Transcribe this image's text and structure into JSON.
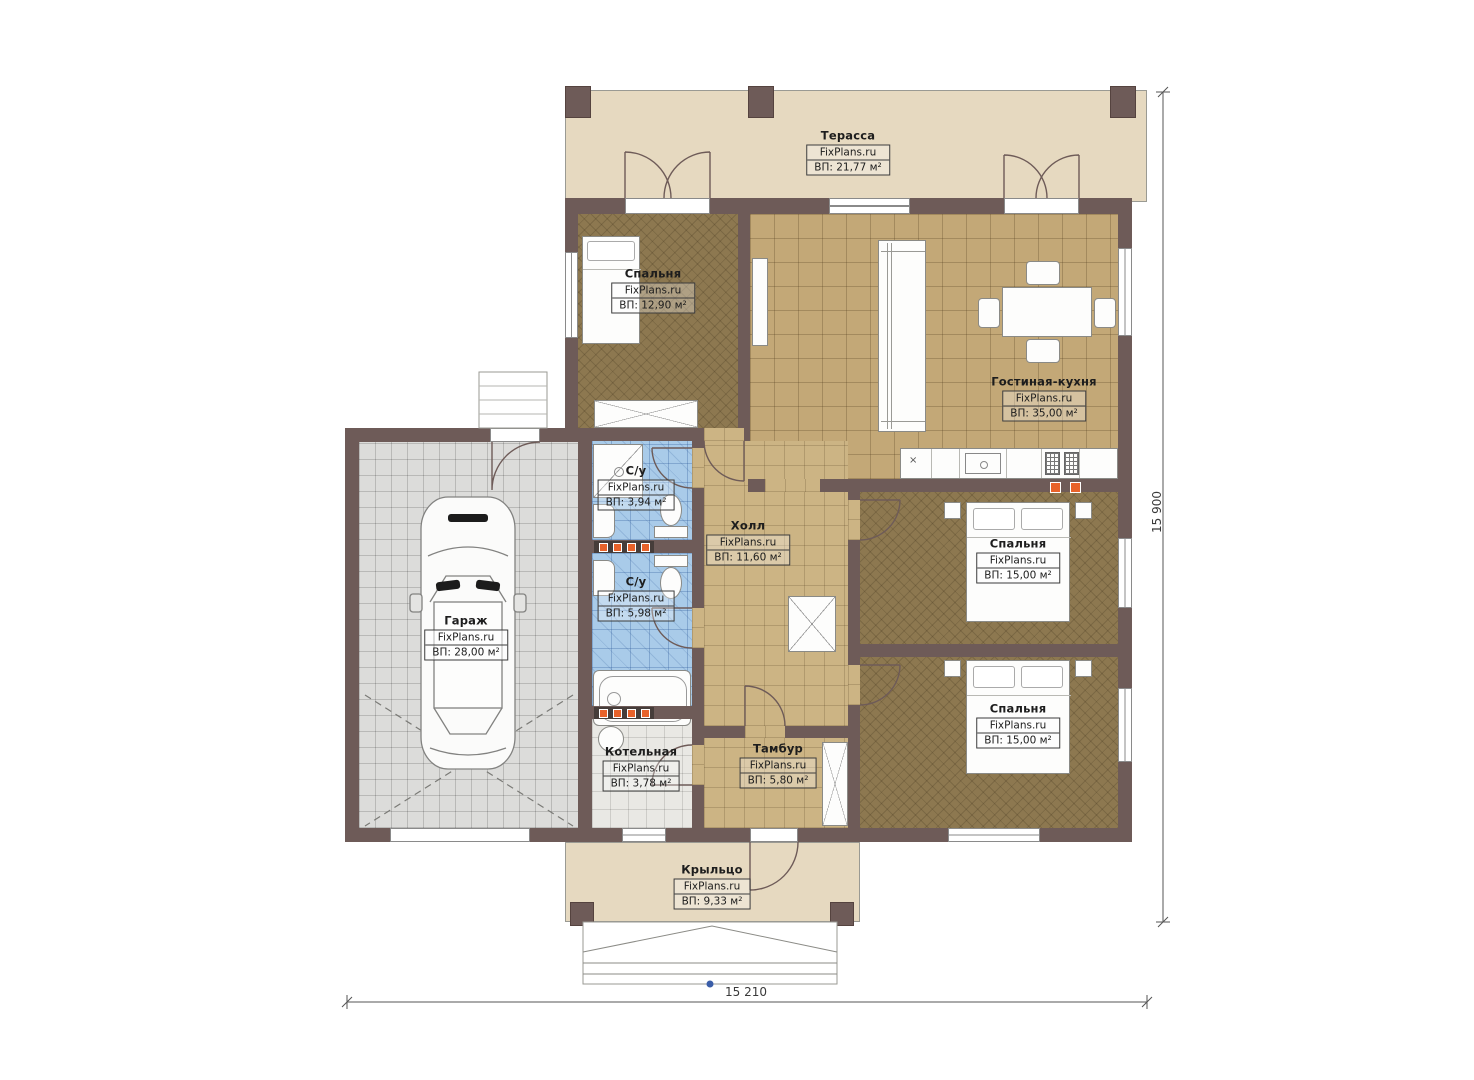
{
  "plan": {
    "site_label": "FixPlans.ru",
    "rooms": {
      "terrace": {
        "name": "Терасса",
        "site": "FixPlans.ru",
        "area": "ВП: 21,77 м²"
      },
      "bedroom1": {
        "name": "Спальня",
        "site": "FixPlans.ru",
        "area": "ВП: 12,90 м²"
      },
      "living_kitchen": {
        "name": "Гостиная-кухня",
        "site": "FixPlans.ru",
        "area": "ВП: 35,00 м²"
      },
      "bathroom1": {
        "name": "С/у",
        "site": "FixPlans.ru",
        "area": "ВП: 3,94 м²"
      },
      "bathroom2": {
        "name": "С/у",
        "site": "FixPlans.ru",
        "area": "ВП: 5,98 м²"
      },
      "hall": {
        "name": "Холл",
        "site": "FixPlans.ru",
        "area": "ВП: 11,60 м²"
      },
      "bedroom2": {
        "name": "Спальня",
        "site": "FixPlans.ru",
        "area": "ВП: 15,00 м²"
      },
      "bedroom3": {
        "name": "Спальня",
        "site": "FixPlans.ru",
        "area": "ВП: 15,00 м²"
      },
      "garage": {
        "name": "Гараж",
        "site": "FixPlans.ru",
        "area": "ВП: 28,00 м²"
      },
      "boiler": {
        "name": "Котельная",
        "site": "FixPlans.ru",
        "area": "ВП: 3,78 м²"
      },
      "vestibule": {
        "name": "Тамбур",
        "site": "FixPlans.ru",
        "area": "ВП: 5,80 м²"
      },
      "porch": {
        "name": "Крыльцо",
        "site": "FixPlans.ru",
        "area": "ВП: 9,33 м²"
      }
    },
    "dimensions": {
      "width_label": "15 210",
      "height_label": "15 900"
    },
    "colors": {
      "wall": "#6e5b58",
      "terrace_floor": "#e6d9c0",
      "living_floor": "#c3a877",
      "hall_floor": "#ccb484",
      "bedroom_floor": "#8d7850",
      "bath_floor": "#a9cbe9",
      "garage_floor": "#dcdcda",
      "boiler_floor": "#e9e8e4",
      "radiator": "#e8622a"
    }
  }
}
